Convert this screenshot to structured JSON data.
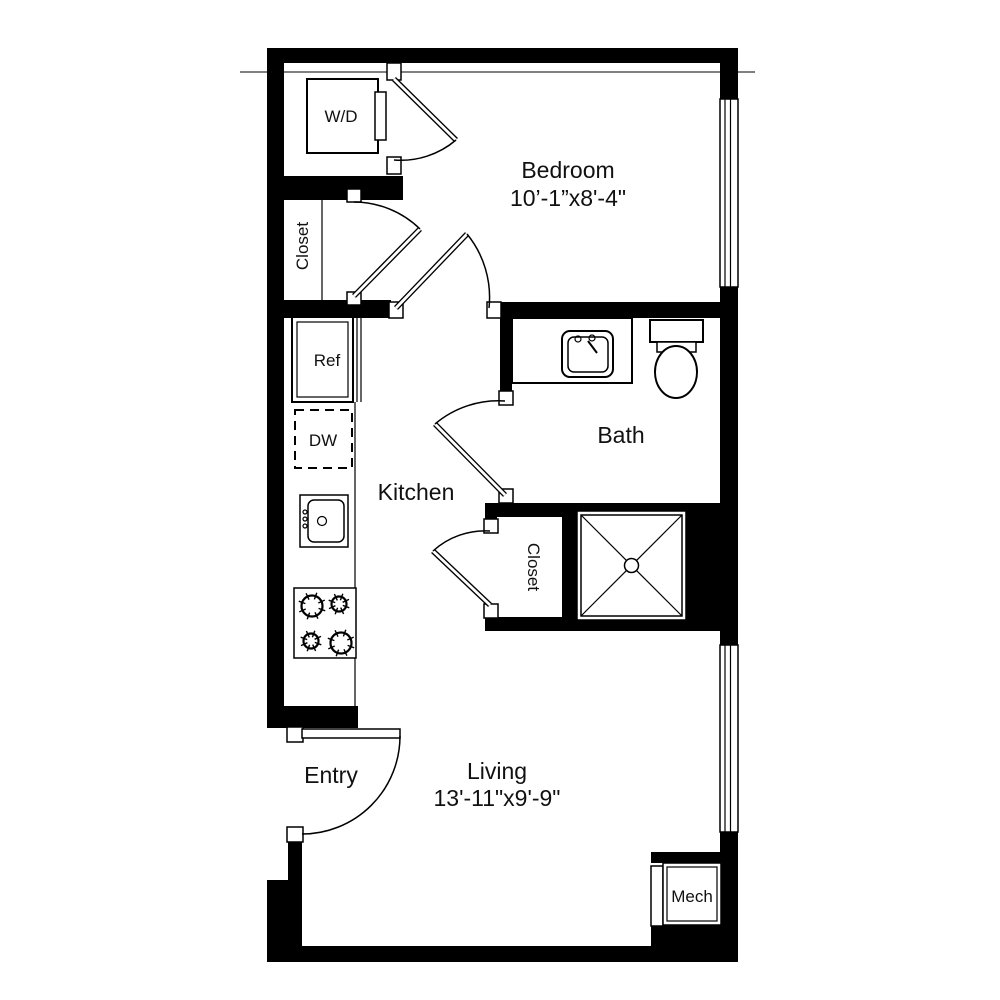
{
  "colors": {
    "wall": "#000000",
    "background": "#ffffff",
    "text": "#111111"
  },
  "rooms": {
    "bedroom": {
      "label": "Bedroom",
      "dimensions": "10’-1”x8'-4\""
    },
    "bath": {
      "label": "Bath"
    },
    "kitchen": {
      "label": "Kitchen"
    },
    "living": {
      "label": "Living",
      "dimensions": "13'-11\"x9'-9\""
    },
    "entry": {
      "label": "Entry"
    },
    "mech": {
      "label": "Mech"
    },
    "bedroom_closet": {
      "label": "Closet"
    },
    "hall_closet": {
      "label": "Closet"
    }
  },
  "appliances": {
    "washer_dryer": {
      "label": "W/D"
    },
    "refrigerator": {
      "label": "Ref"
    },
    "dishwasher": {
      "label": "DW"
    }
  }
}
